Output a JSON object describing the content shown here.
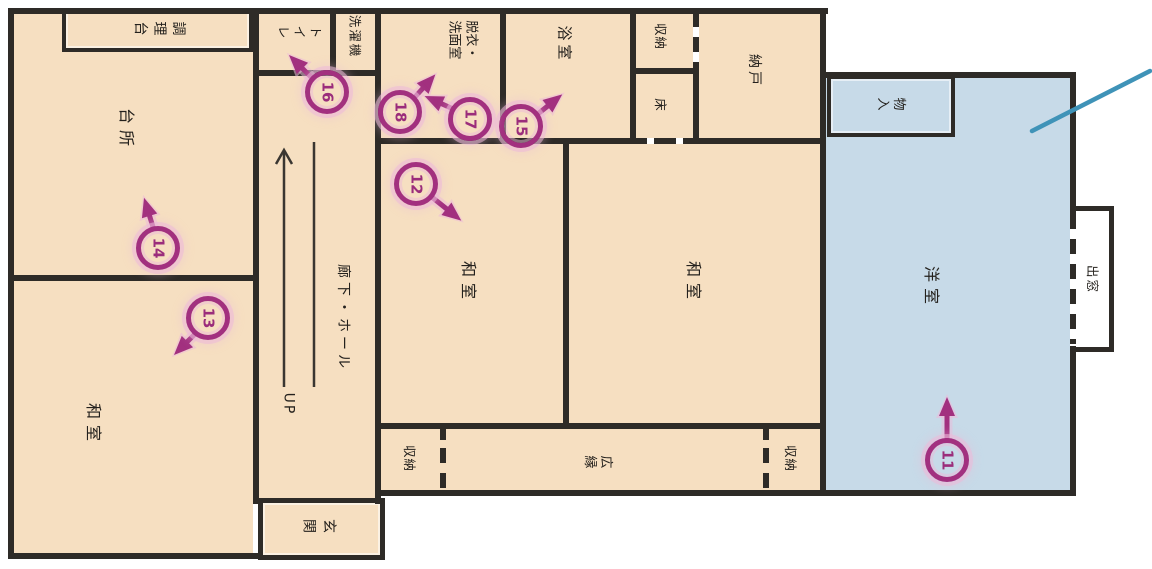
{
  "figure": {
    "type": "floor-plan"
  },
  "colors": {
    "room_fill": "#f6dfc1",
    "western_room_fill": "#c7dae8",
    "wall": "#2e2b27",
    "marker_stroke": "#a2307f",
    "marker_halo": "#ecb9d9",
    "annotation_line": "#3f93b8",
    "background": "#ffffff"
  },
  "rooms": {
    "counter": "調理台",
    "kitchen": "台所",
    "toilet": "トイレ",
    "washer": "洗濯機",
    "dressing_line1": "脱衣・",
    "dressing_line2": "洗面室",
    "bath": "浴室",
    "storage_top": "収納",
    "toko": "床",
    "nando": "納戸",
    "mono_iri": "物入",
    "western_room": "洋室",
    "japanese_room_1": "和室",
    "japanese_room_2": "和室",
    "japanese_room_3": "和室",
    "hall": "廊下・ホール",
    "stairs_up": "UP",
    "entrance": "玄関",
    "storage_bottom_left": "収納",
    "veranda": "広縁",
    "storage_bottom_right": "収納",
    "bay_window": "出窓"
  },
  "markers": {
    "m11": "11",
    "m12": "12",
    "m13": "13",
    "m14": "14",
    "m15": "15",
    "m16": "16",
    "m17": "17",
    "m18": "18"
  }
}
